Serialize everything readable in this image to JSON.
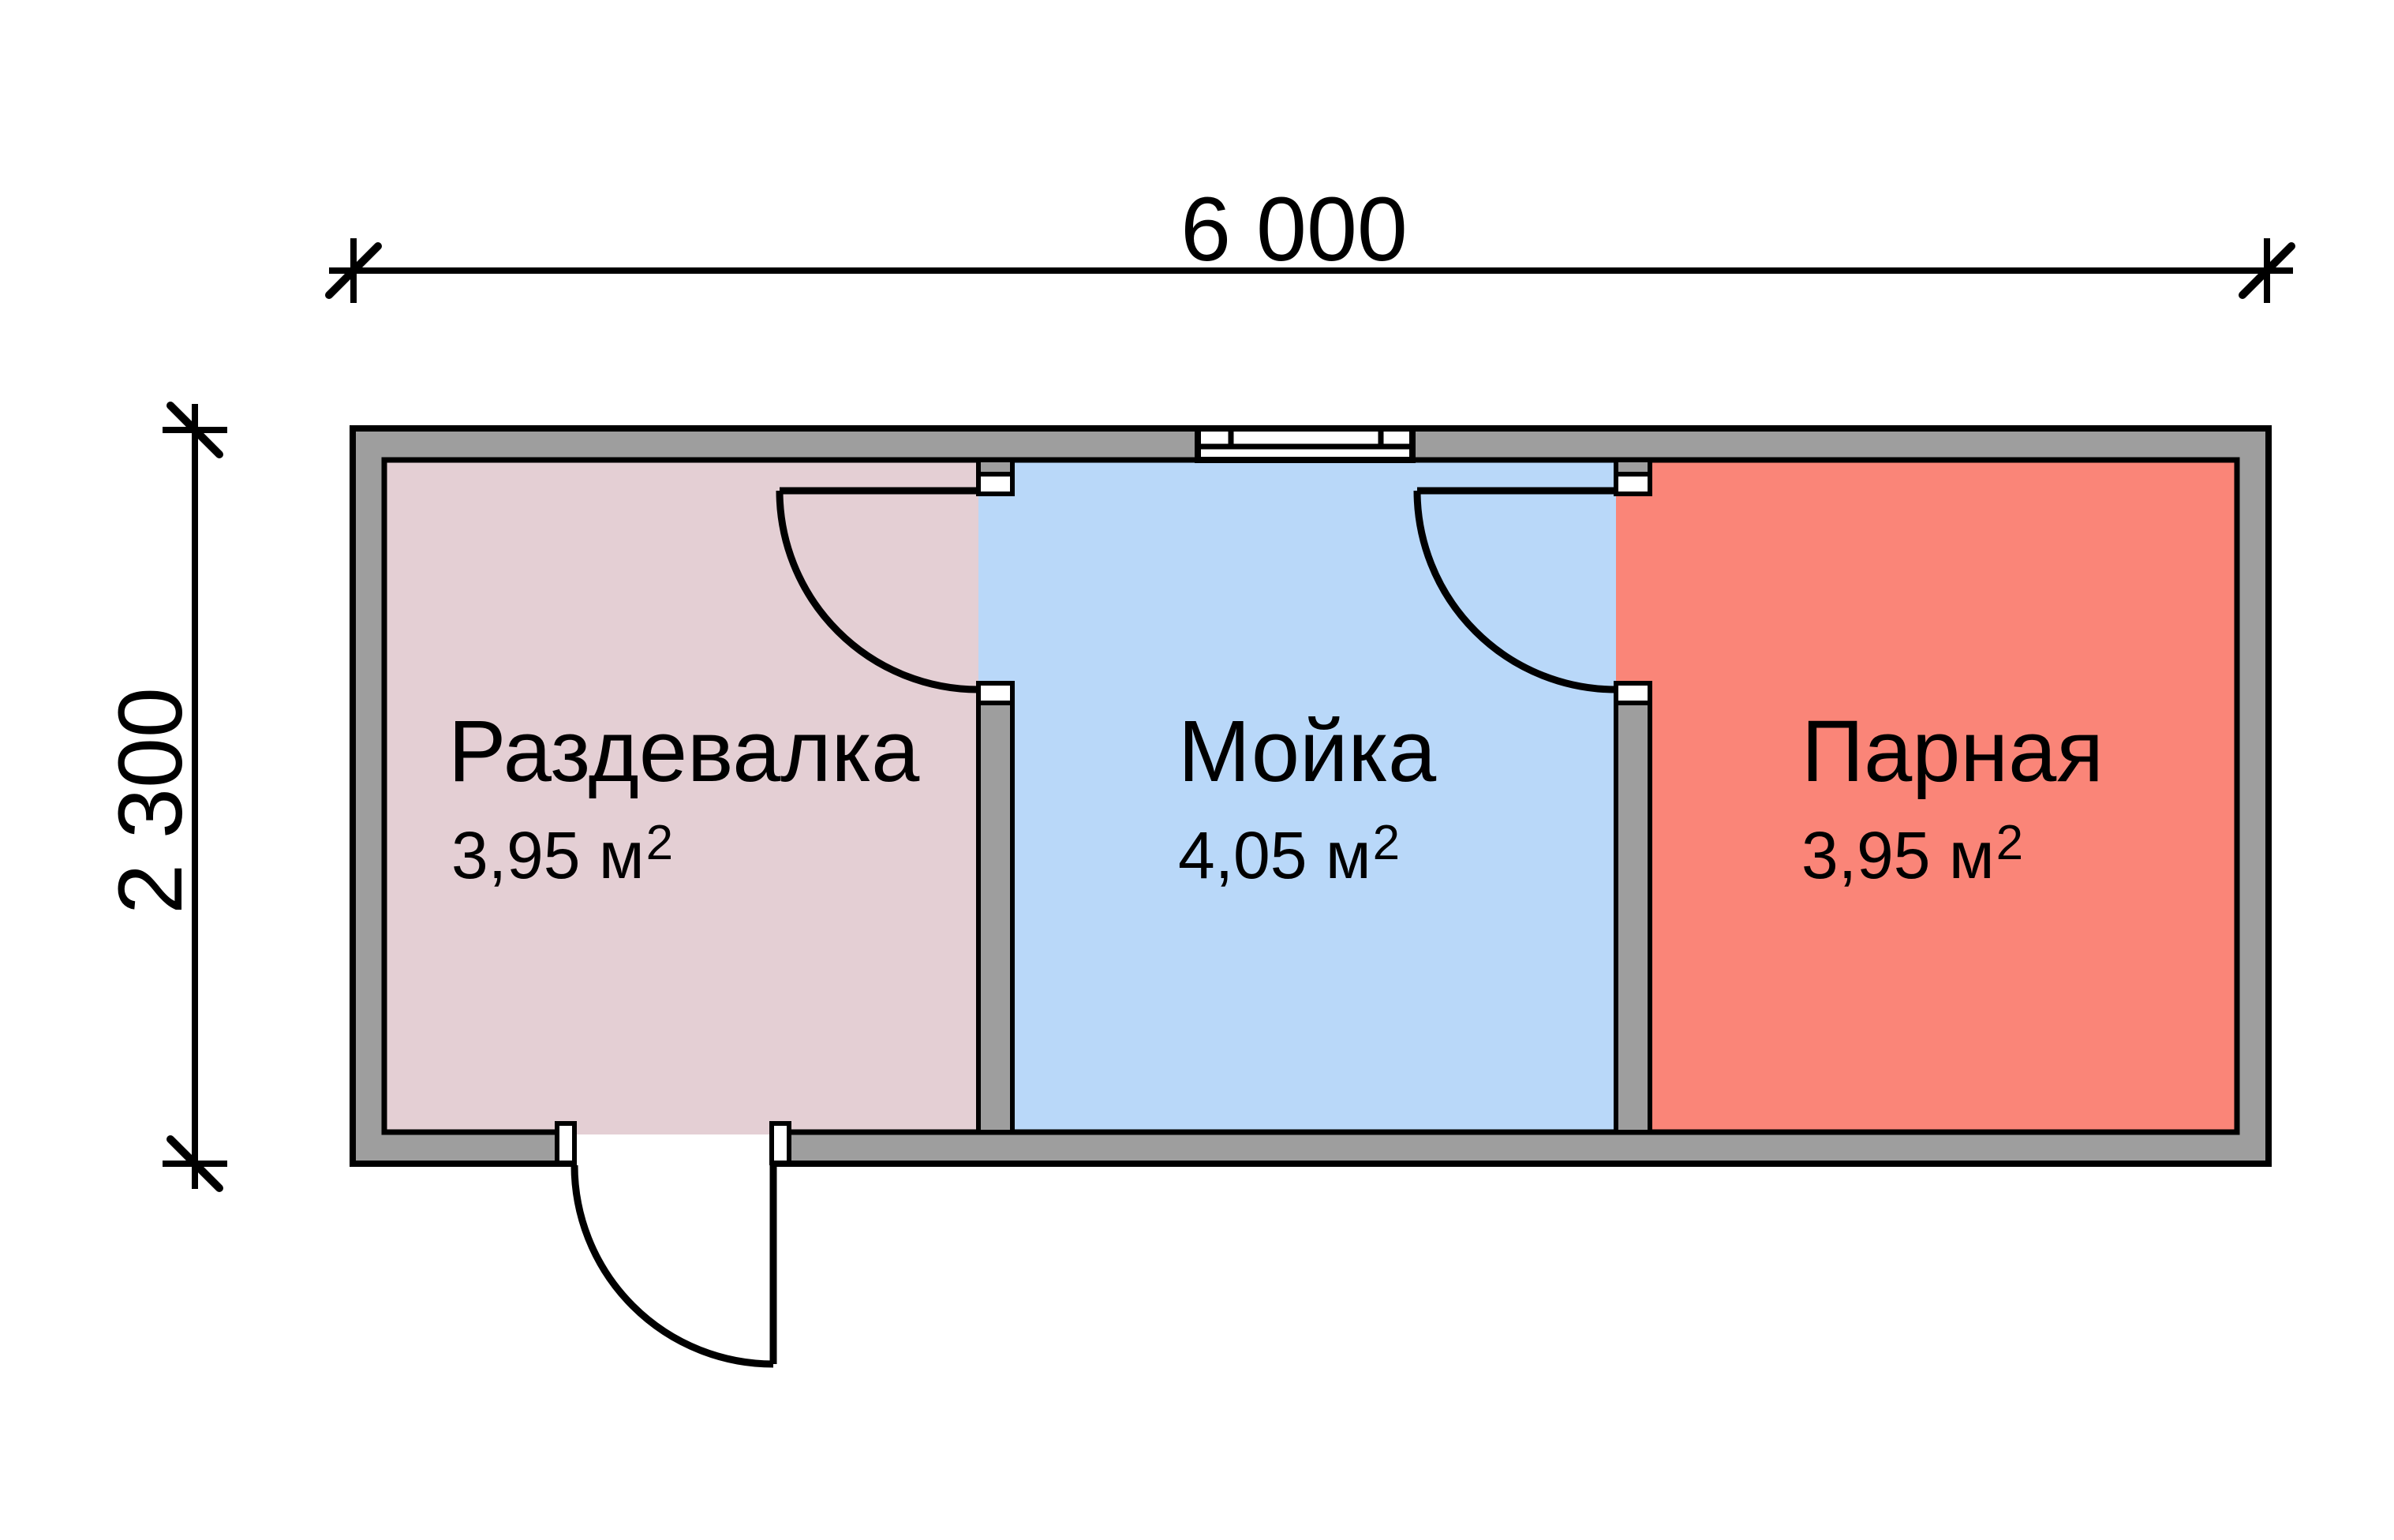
{
  "rooms": [
    {
      "name": "Раздевалка",
      "area_value": "3,95 м",
      "area_superscript": "2",
      "fill": "#e4cfd4"
    },
    {
      "name": "Мойка",
      "area_value": "4,05 м",
      "area_superscript": "2",
      "fill": "#b9d8f9"
    },
    {
      "name": "Парная",
      "area_value": "3,95 м",
      "area_superscript": "2",
      "fill": "#fa8578"
    }
  ],
  "dimensions": {
    "width_label": "6 000",
    "height_label": "2 300"
  },
  "colors": {
    "wall": "#9e9e9e",
    "outline": "#000000",
    "opening": "#ffffff",
    "background": "#ffffff"
  }
}
